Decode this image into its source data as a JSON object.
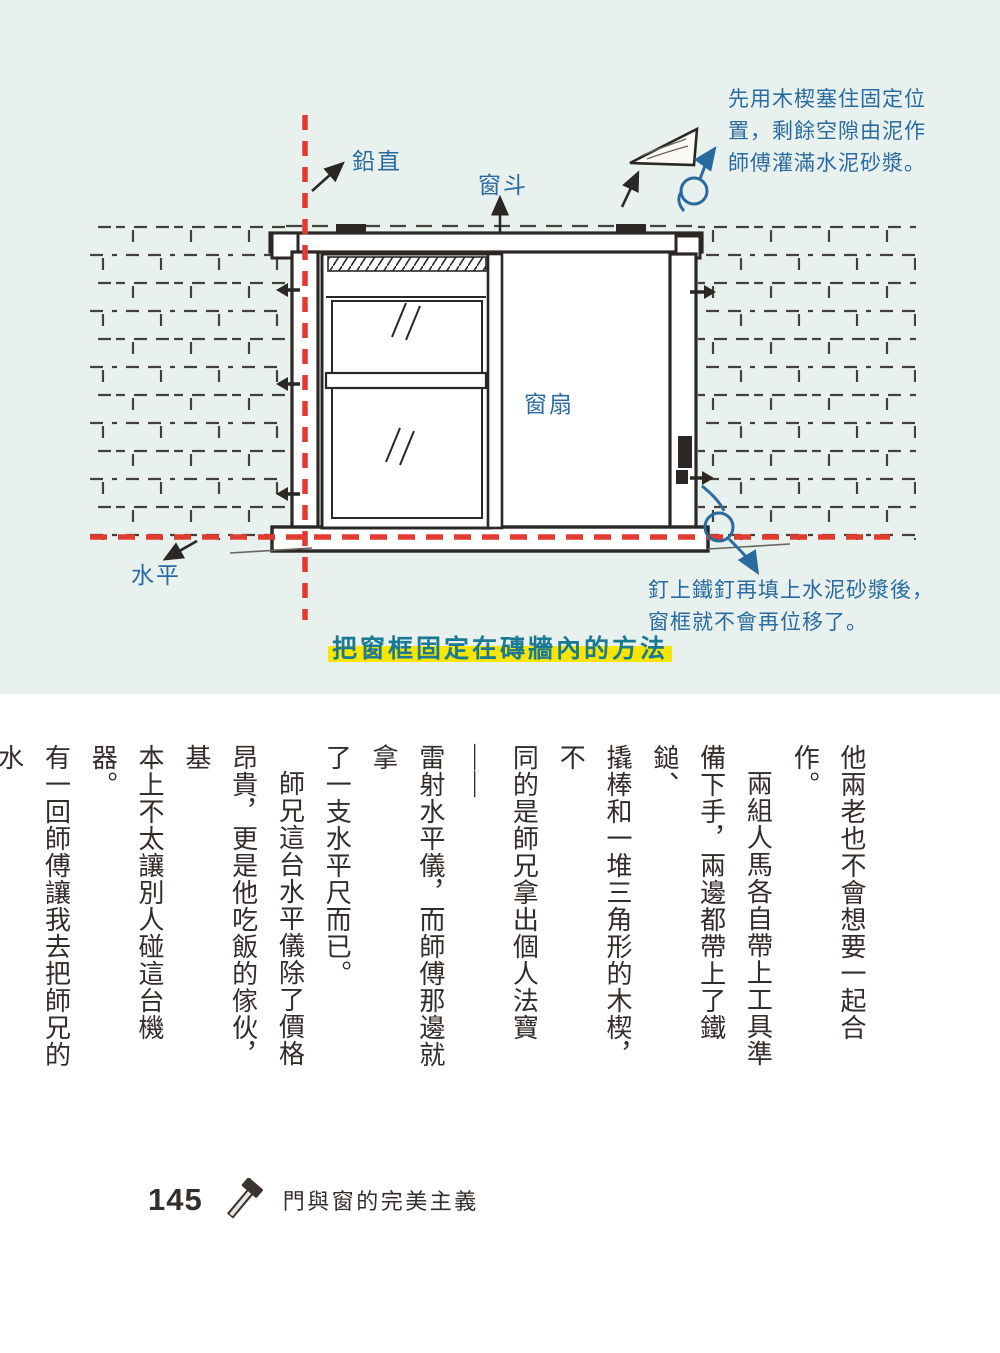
{
  "diagram": {
    "caption": "把窗框固定在磚牆內的方法",
    "labels": {
      "plumb": "鉛直",
      "window_box": "窗斗",
      "window_sash": "窗扇",
      "level": "水平"
    },
    "annotations": {
      "wedge_note": "先用木楔塞住固定位\n置，剩餘空隙由泥作\n師傅灌滿水泥砂漿。",
      "nail_note": "釘上鐵釘再填上水泥砂漿後，\n窗框就不會再位移了。"
    },
    "colors": {
      "wall_background": "#e8f1ee",
      "sketch_black": "#2b2724",
      "guide_red": "#e23a2e",
      "annotation_blue": "#2a6b9f",
      "caption_teal": "#1a7a93",
      "highlight_yellow": "#f9e600"
    }
  },
  "body_text": {
    "columns": [
      "他兩老也不會想要一起合作。",
      "兩組人馬各自帶上工具準",
      "備下手，兩邊都帶上了鐵鎚、",
      "撬棒和一堆三角形的木楔，不",
      "同的是師兄拿出個人法寶——",
      "雷射水平儀，而師傅那邊就拿",
      "了一支水平尺而已。",
      "師兄這台水平儀除了價格",
      "昂貴，更是他吃飯的傢伙，基",
      "本上不太讓別人碰這台機器。",
      "有一回師傅讓我去把師兄的水",
      "平儀拿過來用一下，我沒有先",
      "知會師兄就直接去車上拿過來",
      "用，才剛打開就被師兄抓個正",
      "著，師兄當場發火把我臭罵一",
      "頓，直接就把機器收了回去。"
    ]
  },
  "footer": {
    "page_number": "145",
    "chapter_title": "門與窗的完美主義"
  }
}
